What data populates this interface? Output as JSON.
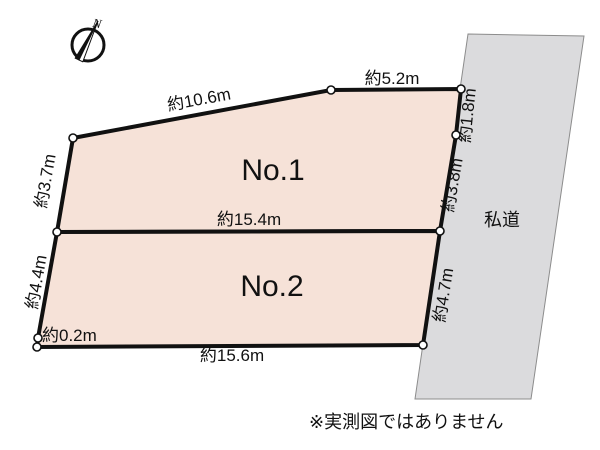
{
  "compass": {
    "north": "N"
  },
  "lots": [
    {
      "label": "No.1"
    },
    {
      "label": "No.2"
    }
  ],
  "road": {
    "label": "私道"
  },
  "measurements": {
    "no1_top_left": "約10.6m",
    "no1_top_right": "約5.2m",
    "no1_left": "約3.7m",
    "no1_right_upper": "約1.8m",
    "no1_right_lower": "約3.8m",
    "divider": "約15.4m",
    "no2_left": "約4.4m",
    "no2_right": "約4.7m",
    "no2_corner": "約0.2m",
    "no2_bottom": "約15.6m"
  },
  "disclaimer": "※実測図ではありません",
  "colors": {
    "lot_fill": "#f6e2d8",
    "road_fill": "#dbdbdd",
    "road_border": "#8c8c8c",
    "line": "#111111"
  }
}
